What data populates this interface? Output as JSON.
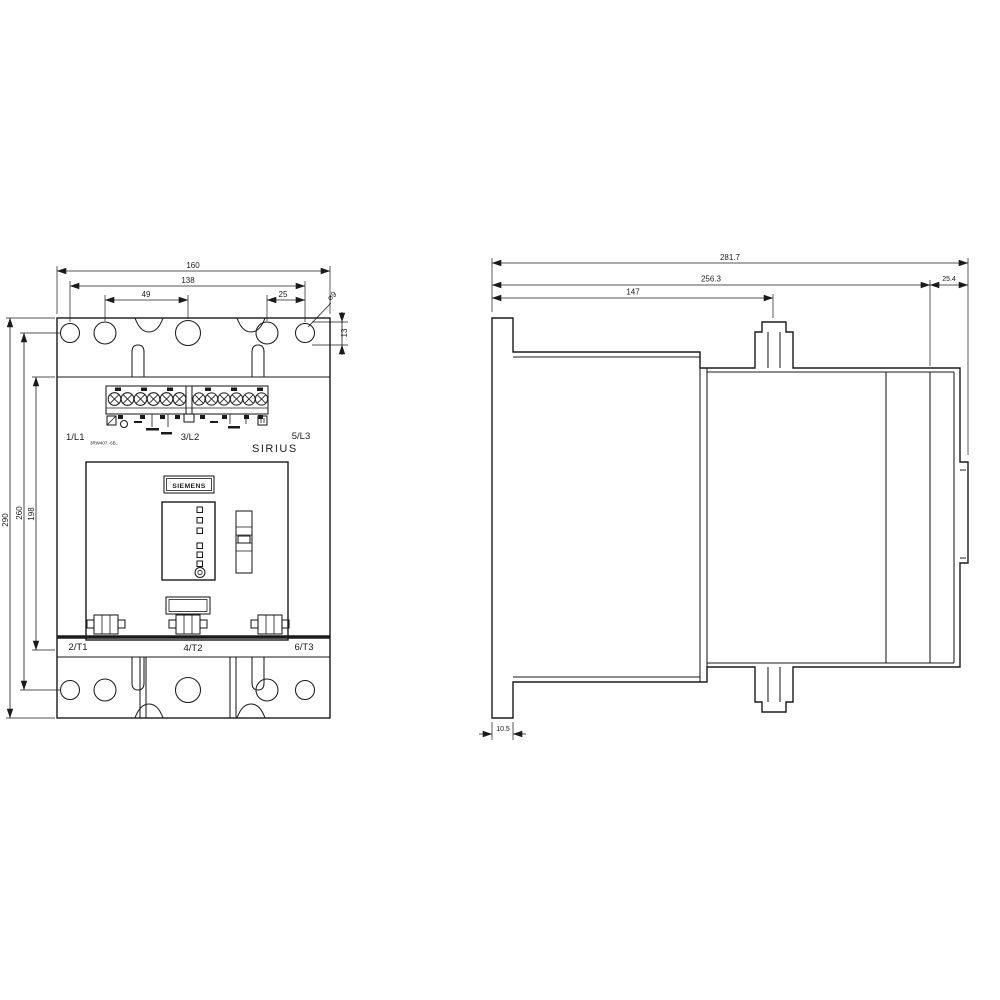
{
  "front": {
    "dim_width_overall": "160",
    "dim_width_mounting": "138",
    "dim_hole_pitch_left": "49",
    "dim_hole_pitch_right": "25",
    "dim_hole_diameter": "⌀9",
    "dim_slot_height": "13",
    "dim_height_overall": "290",
    "dim_height_mounting": "260",
    "dim_height_body": "198",
    "terminal_top_left": "1/L1",
    "type_code": "3RW407.-6B..",
    "terminal_top_middle": "3/L2",
    "terminal_top_right": "5/L3",
    "brand": "SIRIUS",
    "logo": "SIEMENS",
    "terminal_bottom_left": "2/T1",
    "terminal_bottom_middle": "4/T2",
    "terminal_bottom_right": "6/T3"
  },
  "side": {
    "dim_depth_overall": "281.7",
    "dim_depth_mounting": "256.3",
    "dim_depth_front": "147",
    "dim_depth_rail": "25.4",
    "dim_foot": "10.5"
  }
}
